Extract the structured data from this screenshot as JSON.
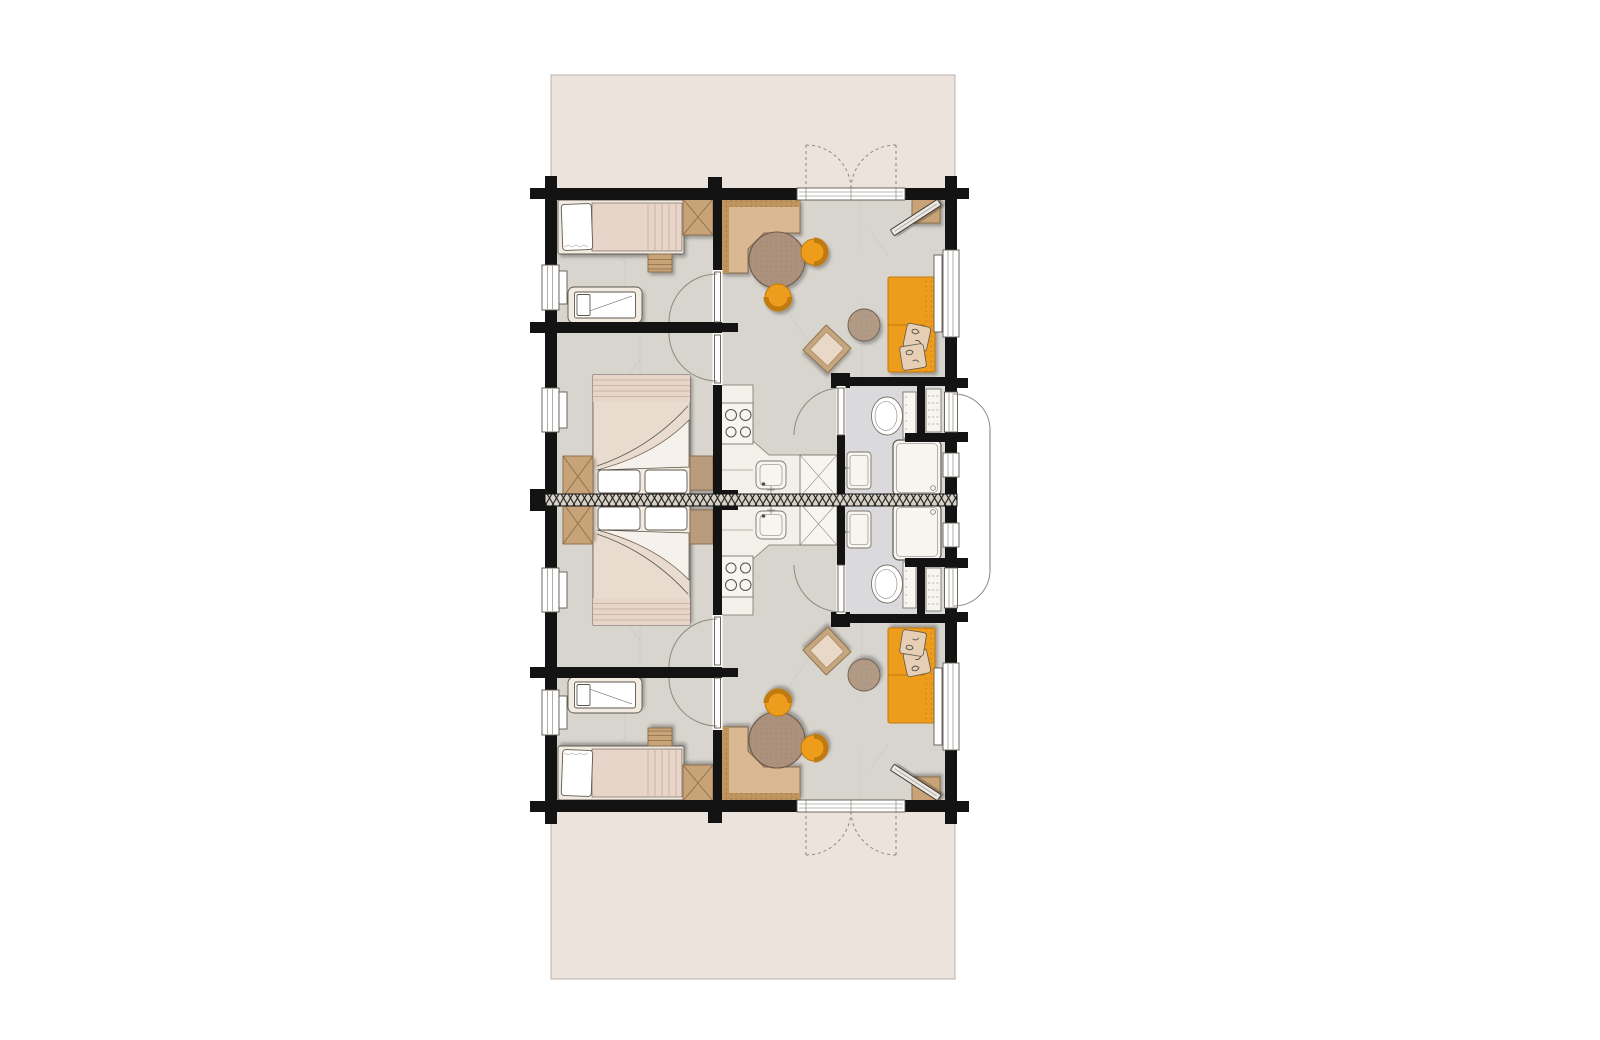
{
  "page": {
    "background": "#ffffff"
  },
  "colors": {
    "page": "#ffffff",
    "wall": "#131313",
    "outline": "#5f584f",
    "fixline": "#7d766d",
    "arc": "#8e8880",
    "terrace": "#ece3dd",
    "terraceedge": "#bab2ab",
    "floor": "#d8d4ce",
    "floorbath": "#dadadc",
    "vein": "#c0bab2",
    "counter": "#f3f0e9",
    "fixture": "#f7f5f0",
    "white": "#ffffff",
    "wood": "#c9a378",
    "wooddark": "#8a6a4a",
    "benchseat": "#dab992",
    "benchback": "#c0945f",
    "table": "#ac927d",
    "pouf": "#b19b87",
    "ottoframe": "#c5a67e",
    "ottocushion": "#ead8c7",
    "orange": "#ee9c1e",
    "orangerim": "#c07a0b",
    "pillow": "#e6cfb5",
    "pillowmark": "#55504a",
    "bedframe": "#f2ebe2",
    "duvet": "#e6d5c8",
    "duvetdark": "#cdb5a1",
    "hatchbase": "#d6d0c9",
    "hatchline": "#23201b",
    "screen": "#9a948d"
  },
  "floorplan": {
    "type": "residential-floor-plan",
    "units_count": 2,
    "arrangement": "two-mirrored-units-sharing-central-party-wall",
    "terraces": [
      "top-terrace",
      "bottom-terrace"
    ],
    "unit_rooms": [
      {
        "name": "children-bedroom",
        "furniture": [
          "single-bed",
          "bedside-dresser",
          "wardrobe",
          "baby-crib"
        ],
        "windows": 1
      },
      {
        "name": "master-bedroom",
        "furniture": [
          "double-bed",
          "wardrobe",
          "dresser"
        ],
        "windows": 1
      },
      {
        "name": "kitchen-living-room",
        "furniture": [
          "corner-bench",
          "round-dining-table",
          "dining-chair",
          "dining-chair",
          "ottoman",
          "pouf",
          "sofa",
          "sofa-pillows",
          "tv-stand",
          "tv",
          "kitchen-counter",
          "cooktop",
          "kitchen-sink",
          "refrigerator"
        ],
        "windows": 1
      },
      {
        "name": "bathroom",
        "furniture": [
          "toilet",
          "washbasin",
          "shower"
        ],
        "windows": 1
      },
      {
        "name": "storage-closet",
        "furniture": [
          "shelf-unit"
        ]
      }
    ],
    "unit_doors": [
      "french-doors-to-terrace",
      "children-bedroom-door",
      "master-bedroom-door",
      "bathroom-door",
      "entrance-door"
    ],
    "shared_elements": [
      "party-wall-hatched",
      "outdoor-privacy-screen"
    ]
  }
}
